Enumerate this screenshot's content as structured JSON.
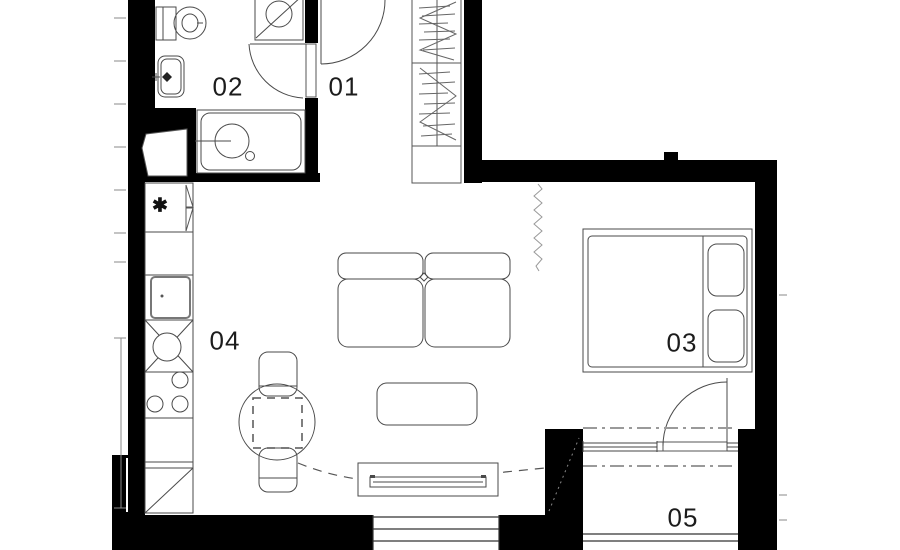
{
  "plan": {
    "rooms": [
      {
        "id": "room-01",
        "label": "01"
      },
      {
        "id": "room-02",
        "label": "02"
      },
      {
        "id": "room-03",
        "label": "03"
      },
      {
        "id": "room-04",
        "label": "04"
      },
      {
        "id": "room-05",
        "label": "05"
      }
    ],
    "markers": {
      "fridge": "✱"
    },
    "colors": {
      "wall": "#000000",
      "line": "#4a4a4a",
      "light_line": "#8a8a8a",
      "label": "#1c1c1c",
      "background": "#ffffff"
    }
  }
}
